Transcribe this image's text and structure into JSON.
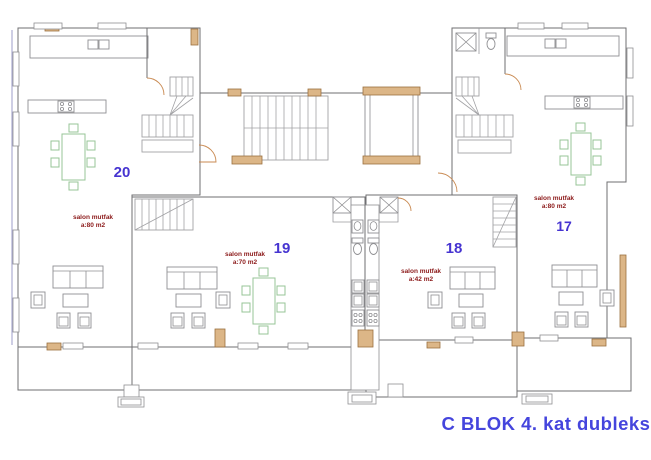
{
  "plan_title": "C BLOK 4. kat dubleks",
  "apartments": [
    {
      "number": "20",
      "room_label": "salon mutfak",
      "area_label": "a:80 m2",
      "fill": "orange"
    },
    {
      "number": "19",
      "room_label": "salon mutfak",
      "area_label": "a:70 m2",
      "fill": "gray"
    },
    {
      "number": "18",
      "room_label": "salon mutfak",
      "area_label": "a:42 m2",
      "fill": "orange"
    },
    {
      "number": "17",
      "room_label": "salon mutfak",
      "area_label": "a:80 m2",
      "fill": "gray"
    }
  ],
  "colors": {
    "unit_orange": "#f7c78d",
    "unit_gray": "#b9b9bc",
    "column_tan": "#dcb687",
    "apartment_number_blue": "#4634d1",
    "room_label_red": "#8c1a1a",
    "title_blue": "#4545dd",
    "wall_gray": "#6f6f72",
    "furniture_green": "#97c497",
    "door_swing_orange": "#c98a52"
  },
  "furniture_icons": [
    "dining-table",
    "chair",
    "sofa",
    "armchair",
    "coffee-table",
    "tv-unit",
    "shower",
    "toilet",
    "washbasin",
    "kitchen-sink",
    "stove",
    "staircase",
    "elevator",
    "door-swing",
    "column",
    "window"
  ]
}
